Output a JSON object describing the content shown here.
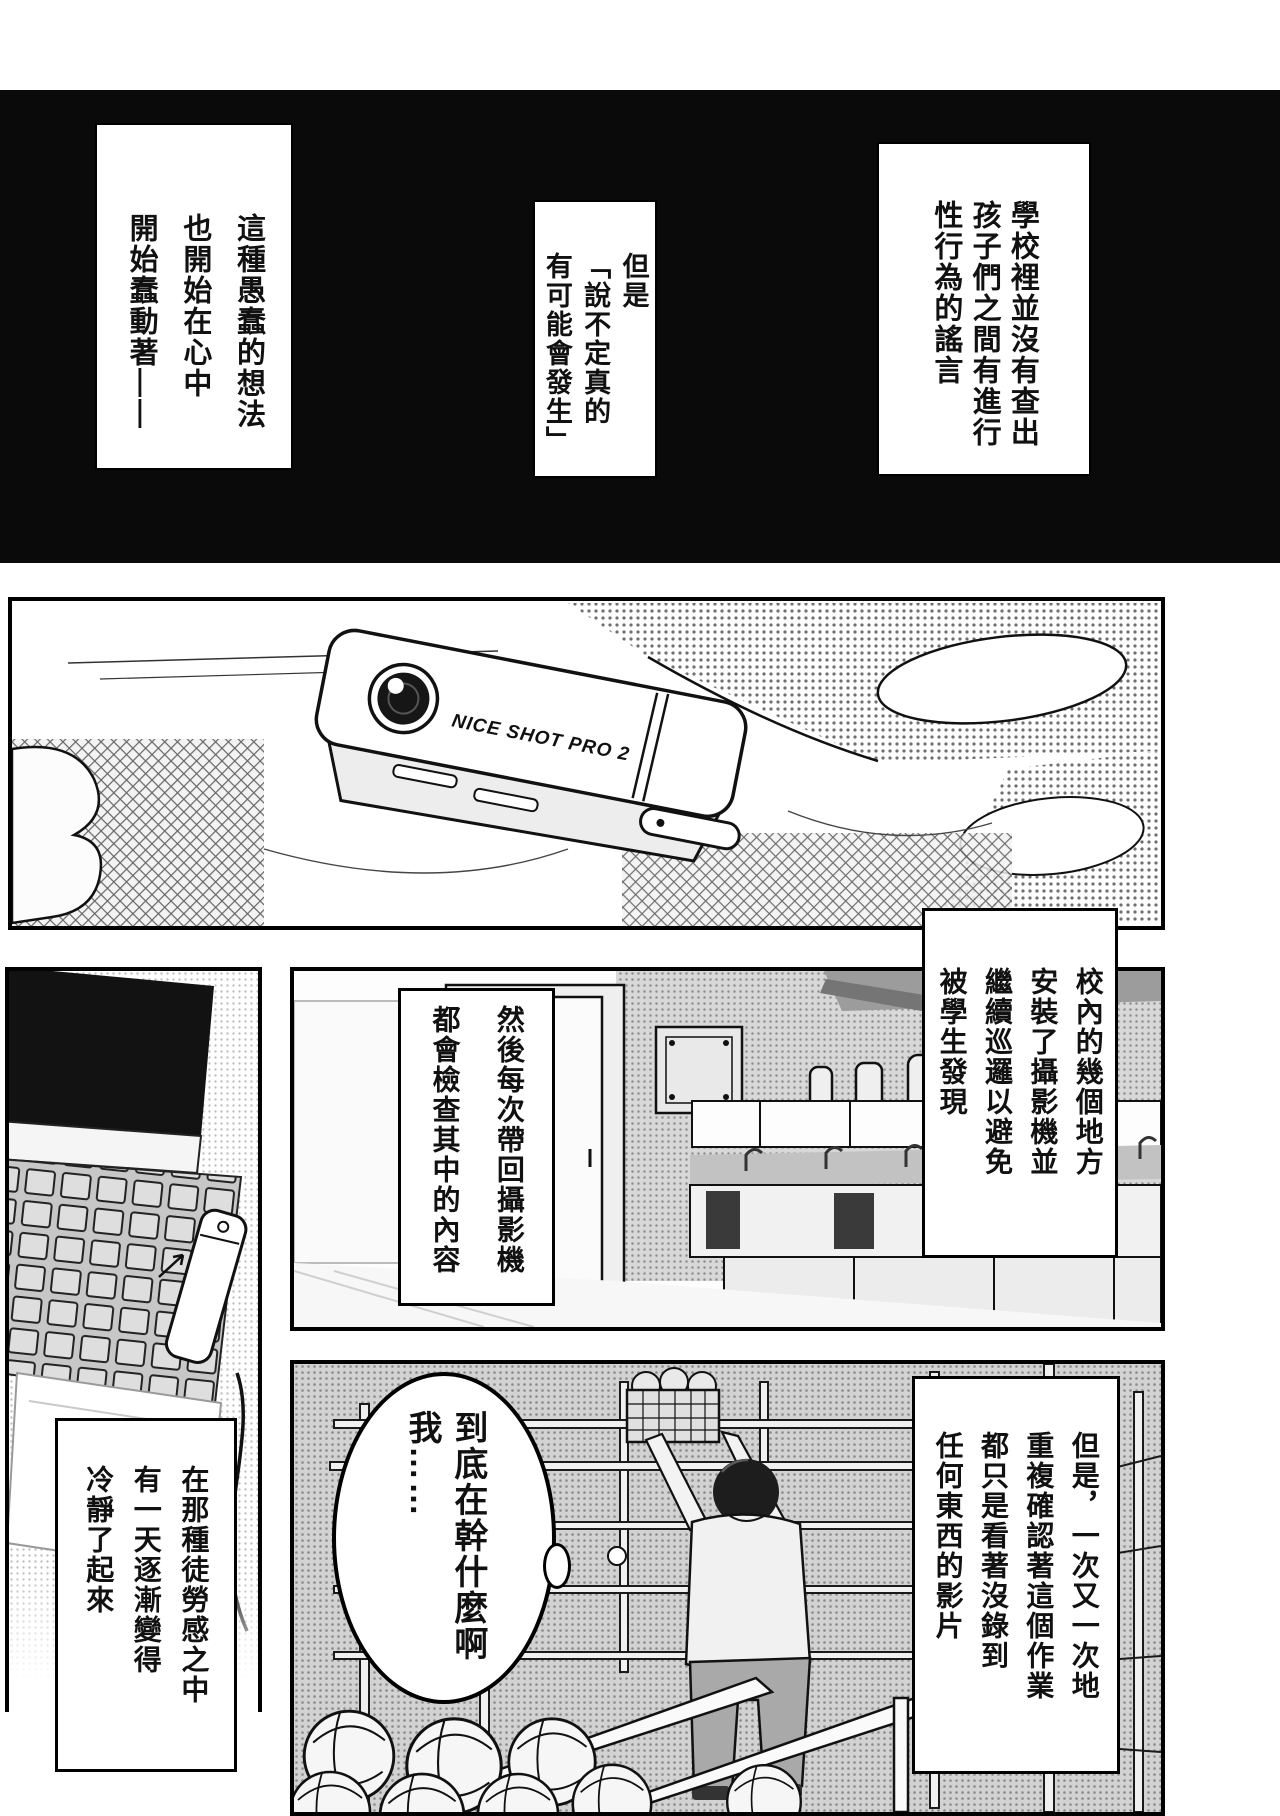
{
  "page": {
    "bg": "#ffffff",
    "ink": "#111111",
    "black_band": "#0a0a0a"
  },
  "narration": {
    "rumor": "學校裡並沒有查出\n孩子們之間有進行\n性行為的謠言",
    "but_maybe": "但是\n「說不定真的\n有可能會發生」",
    "foolish_idea": "這種愚蠢的想法\n也開始在心中\n開始蠢動著——",
    "cameras_installed": "校內的幾個地方\n安裝了攝影機並\n繼續巡邏以避免\n被學生發現",
    "content_checked": "然後每次帶回攝影機\n都會檢查其中的內容",
    "futile_work": "但是，一次又一次地\n重複確認著這個作業\n都只是看著沒錄到\n任何東西的影片",
    "calming_down": "在那種徒勞感之中\n有一天逐漸變得\n冷靜了起來"
  },
  "speech": {
    "bubble_text": "到底在幹什麼啊\n我……"
  },
  "camera_device": {
    "brand_label": "NICE SHOT PRO 2"
  }
}
